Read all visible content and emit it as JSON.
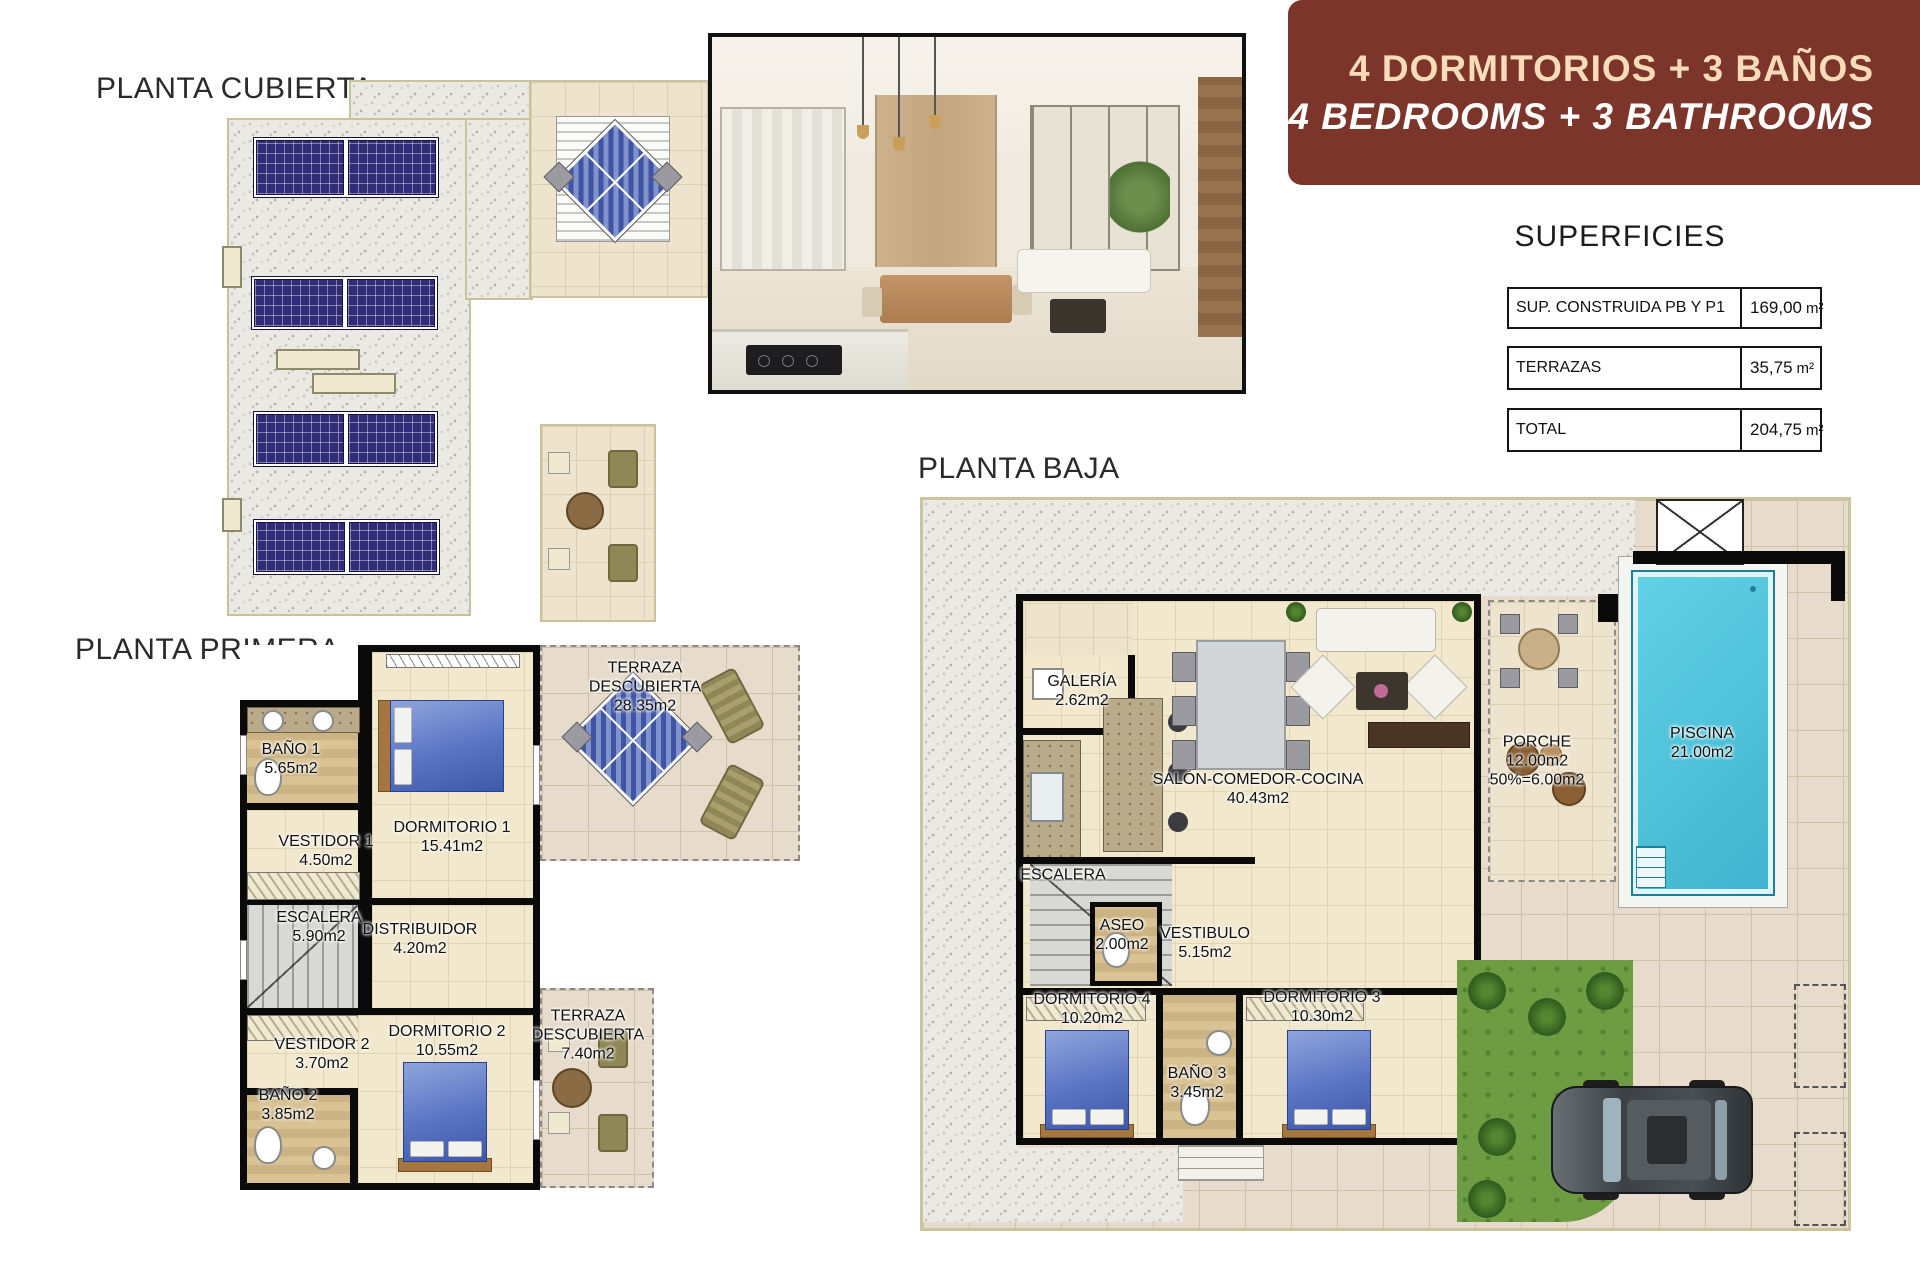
{
  "titles": {
    "roof_plan": "PLANTA CUBIERTA",
    "first_floor_plan": "PLANTA PRIMERA",
    "ground_floor_plan": "PLANTA BAJA"
  },
  "banner": {
    "line1": "4 DORMITORIOS + 3 BAÑOS",
    "line2": "4 BEDROOMS + 3 BATHROOMS",
    "bg_color": "#7b352b",
    "line1_color": "#f8dcba",
    "line2_color": "#ffffff"
  },
  "superficies": {
    "heading": "SUPERFICIES",
    "rows": [
      {
        "label": "SUP. CONSTRUIDA PB Y P1",
        "value": "169,00",
        "unit": "m²"
      },
      {
        "label": "TERRAZAS",
        "value": "35,75",
        "unit": "m²"
      },
      {
        "label": "TOTAL",
        "value": "204,75",
        "unit": "m²"
      }
    ]
  },
  "first_floor": {
    "rooms": [
      {
        "name": "BAÑO 1",
        "area": "5.65m2"
      },
      {
        "name": "VESTIDOR 1",
        "area": "4.50m2"
      },
      {
        "name": "DORMITORIO 1",
        "area": "15.41m2"
      },
      {
        "name": "TERRAZA DESCUBIERTA",
        "area": "28.35m2"
      },
      {
        "name": "ESCALERA",
        "area": "5.90m2"
      },
      {
        "name": "DISTRIBUIDOR",
        "area": "4.20m2"
      },
      {
        "name": "VESTIDOR 2",
        "area": "3.70m2"
      },
      {
        "name": "BAÑO 2",
        "area": "3.85m2"
      },
      {
        "name": "DORMITORIO 2",
        "area": "10.55m2"
      },
      {
        "name": "TERRAZA DESCUBIERTA",
        "area": "7.40m2"
      }
    ]
  },
  "ground_floor": {
    "rooms": [
      {
        "name": "GALERÍA",
        "area": "2.62m2"
      },
      {
        "name": "SALÓN-COMEDOR-COCINA",
        "area": "40.43m2"
      },
      {
        "name": "PORCHE",
        "area": "12.00m2",
        "extra": "50%=6.00m2"
      },
      {
        "name": "PISCINA",
        "area": "21.00m2"
      },
      {
        "name": "ESCALERA",
        "area": ""
      },
      {
        "name": "ASEO",
        "area": "2.00m2"
      },
      {
        "name": "VESTIBULO",
        "area": "5.15m2"
      },
      {
        "name": "DORMITORIO 4",
        "area": "10.20m2"
      },
      {
        "name": "BAÑO 3",
        "area": "3.45m2"
      },
      {
        "name": "DORMITORIO 3",
        "area": "10.30m2"
      }
    ]
  },
  "colors": {
    "pool": "#4cc7de",
    "grass": "#6d9c42",
    "solar_panel": "#312c78",
    "interior_floor": "#f2e8cd",
    "terrace_tile": "#e7dccb"
  }
}
